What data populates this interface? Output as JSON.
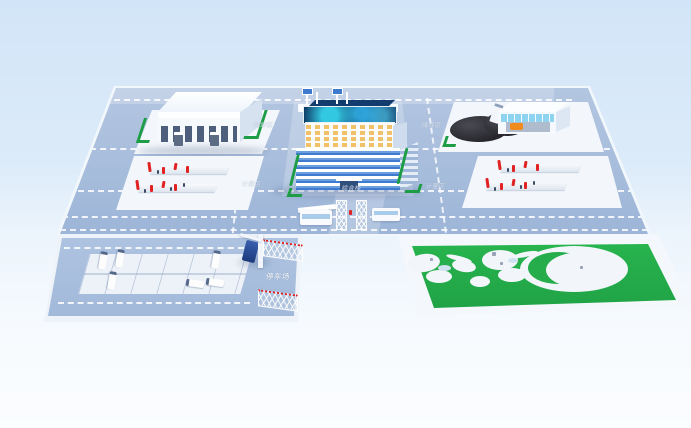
{
  "labels": {
    "parking_lot": "停车场",
    "loading_area": "装卸区",
    "coal_storage_area": "储煤区",
    "weighing_area_left": "计量区",
    "weighing_area_right": "计量区",
    "main_building": "综合楼"
  },
  "colors": {
    "background_top": "#d2e5f8",
    "background_bottom": "#fbfdff",
    "platform": "#a6bcdb",
    "road_marking": "#ffffff",
    "pad_white": "#f3f7fb",
    "hedge_green": "#1d9d45",
    "park_green": "#29b750",
    "coal_black": "#26262c",
    "equipment_red": "#e02222",
    "glass_blue": "#3f7bd0",
    "screen_navy": "#0a2c5a",
    "screen_cyan": "#35d0e8",
    "loader_orange": "#f08c1e",
    "truck_blue": "#1d3a7c"
  }
}
